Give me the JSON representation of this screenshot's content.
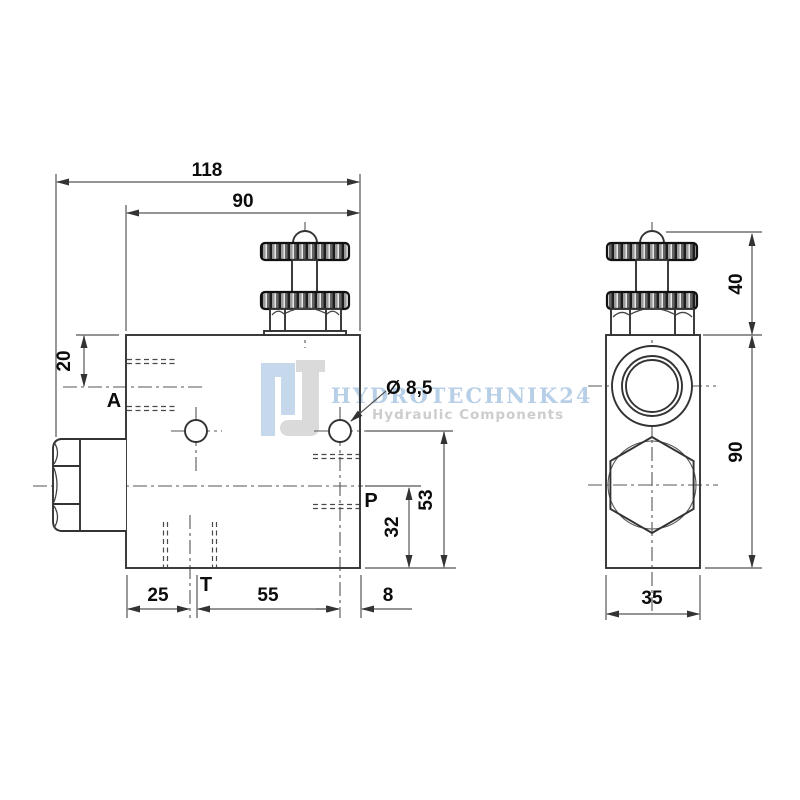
{
  "watermark": {
    "logo_letter_h": "H",
    "logo_letter_j": "J",
    "brand": "HYDROTECHNIK24",
    "tagline": "Hydraulic Components"
  },
  "front_view": {
    "dims": {
      "total_width": "118",
      "body_width": "90",
      "port_a_offset": "20",
      "t_from_left": "25",
      "hole_spacing": "55",
      "hole_to_edge": "8",
      "port_p_height": "32",
      "hole_height": "53"
    },
    "labels": {
      "port_a": "A",
      "port_p": "P",
      "port_t": "T",
      "hole_diameter": "Ø 8,5"
    }
  },
  "side_view": {
    "dims": {
      "knob_height": "40",
      "body_height": "90",
      "body_depth": "35"
    }
  },
  "colors": {
    "line": "#333333",
    "dimension": "#555555",
    "text": "#0c0c0c",
    "watermark_blue": "#c6d9ec",
    "watermark_gray": "#dadada",
    "knurl_dark": "#2f2f2f"
  }
}
